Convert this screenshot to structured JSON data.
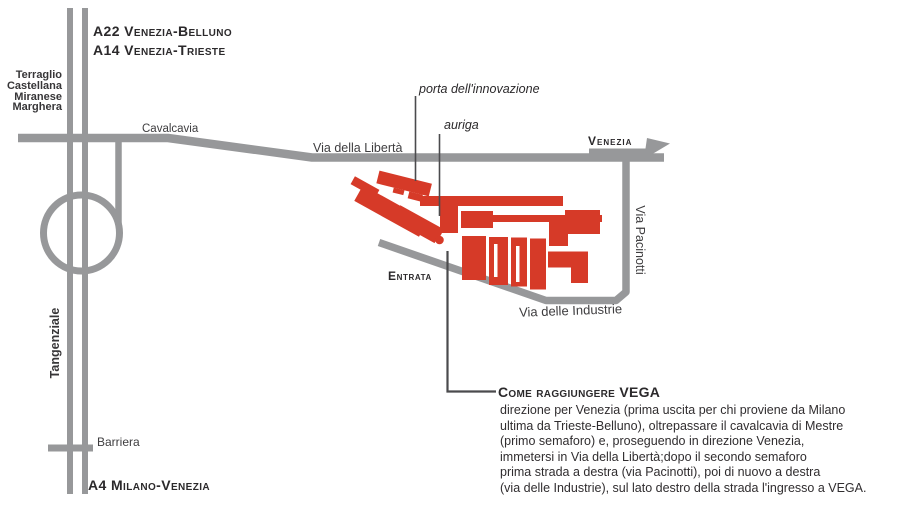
{
  "map": {
    "highways_top": {
      "line1": "A22 Venezia-Belluno",
      "line2": "A14 Venezia-Trieste"
    },
    "exit_stack": [
      "Terraglio",
      "Castellana",
      "Miranese",
      "Marghera"
    ],
    "roads": {
      "cavalcavia": "Cavalcavia",
      "via_della_liberta": "Via della Libertà",
      "venezia": "Venezia",
      "tangenziale": "Tangenziale",
      "barriera": "Barriera",
      "a4": "A4 Milano-Venezia",
      "via_pacinotti": "Via Pacinotti",
      "via_delle_industrie": "Via delle Industrie",
      "entrata": "Entrata"
    },
    "buildings": {
      "porta": "porta dell'innovazione",
      "auriga": "auriga"
    }
  },
  "directions": {
    "title": "Come raggiungere VEGA",
    "lines": [
      "direzione per Venezia (prima uscita per chi proviene da Milano",
      "ultima da Trieste-Belluno), oltrepassare il cavalcavia di Mestre",
      "(primo semaforo) e, proseguendo in direzione Venezia,",
      "immetersi in Via della Libertà;dopo il secondo semaforo",
      "prima strada  a destra (via Pacinotti), poi di nuovo a destra",
      "(via delle Industrie), sul lato destro della strada l'ingresso a VEGA."
    ]
  },
  "colors": {
    "road_gray": "#97989a",
    "building_red": "#d63a28",
    "leader_dark": "#4b4b4d",
    "text_dark": "#2b292b"
  }
}
